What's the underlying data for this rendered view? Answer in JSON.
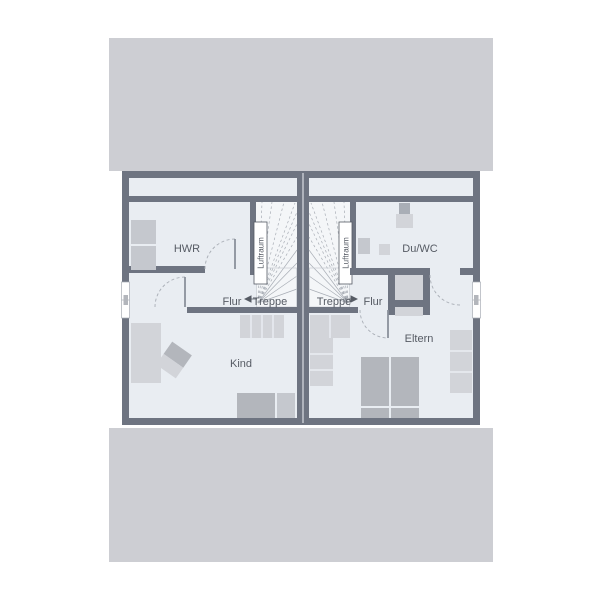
{
  "floorplan": {
    "left_unit": {
      "hwr": "HWR",
      "flur": "Flur",
      "treppe": "Treppe",
      "luftraum": "Luftraum",
      "kind": "Kind"
    },
    "right_unit": {
      "duwc": "Du/WC",
      "flur": "Flur",
      "treppe": "Treppe",
      "luftraum": "Luftraum",
      "eltern": "Eltern"
    }
  },
  "colors": {
    "roof": "#cdced3",
    "wall": "#6e7481",
    "floor": "#e9edf2",
    "stair_floor": "#f4f6f8",
    "furn_light": "#d2d4d9",
    "furn_mid": "#c5c8ce",
    "furn_dark": "#b3b6bc",
    "accent_gray": "#a9aeb6",
    "text": "#565b64",
    "thin": "#a8adb5",
    "leaf": "#8a909b",
    "outline": "#c5cad1",
    "seam": "#f0f2f6"
  }
}
